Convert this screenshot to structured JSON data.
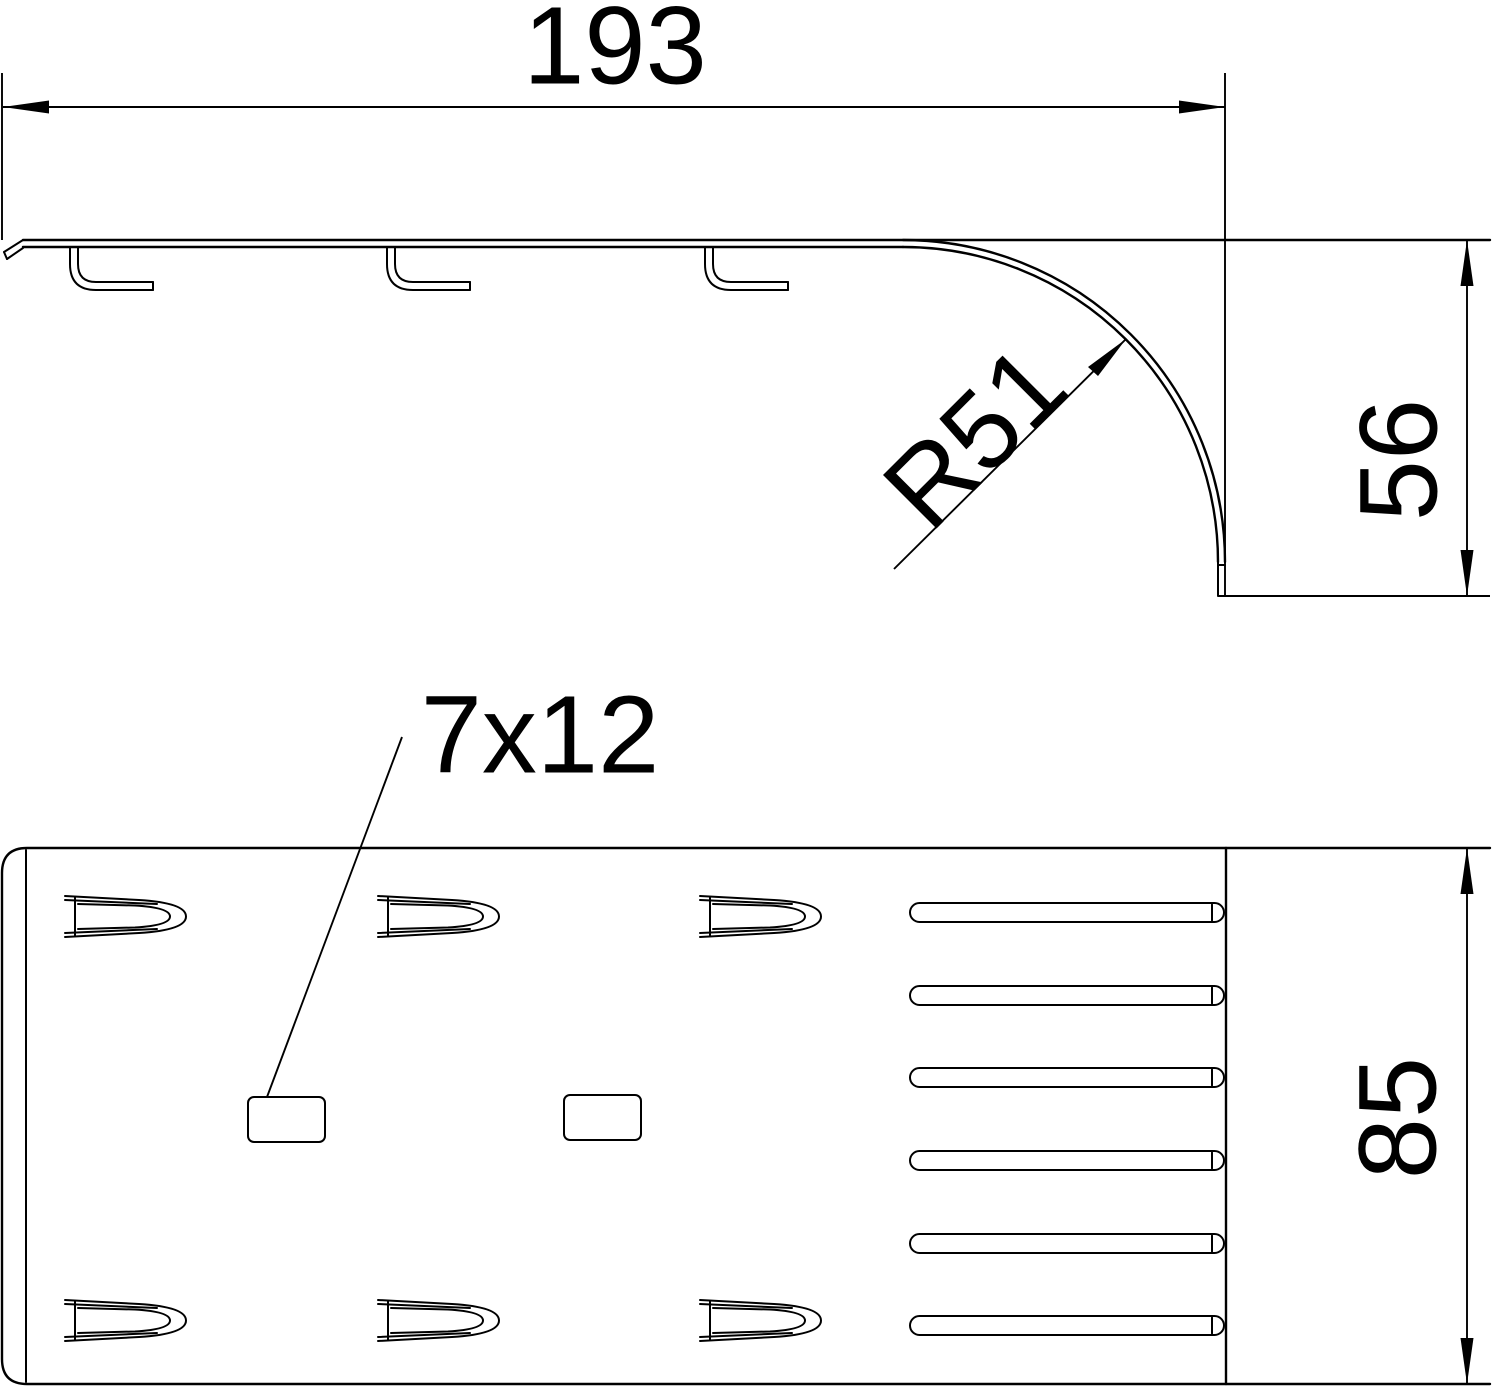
{
  "drawing_title": "Dimensioned technical drawing, two views of sheet-metal cover end piece",
  "colors": {
    "ink": "#000000",
    "paper": "#ffffff"
  },
  "side_view": {
    "length_label": "193",
    "height_label": "56",
    "radius_label": "R51"
  },
  "plan_view": {
    "slot_size_label": "7x12",
    "width_label": "85"
  },
  "geometry": {
    "side": {
      "hooks_x": [
        70,
        387,
        705
      ]
    },
    "plan": {
      "tongue_xs": [
        65,
        378,
        700
      ],
      "tongue_rows_y": [
        894,
        1298
      ],
      "drain_slot_x": 910,
      "drain_slots_y": [
        903,
        986,
        1068,
        1151,
        1234,
        1316
      ],
      "rect_slots": [
        {
          "x": 248,
          "y": 1097
        },
        {
          "x": 564,
          "y": 1095
        }
      ]
    }
  }
}
